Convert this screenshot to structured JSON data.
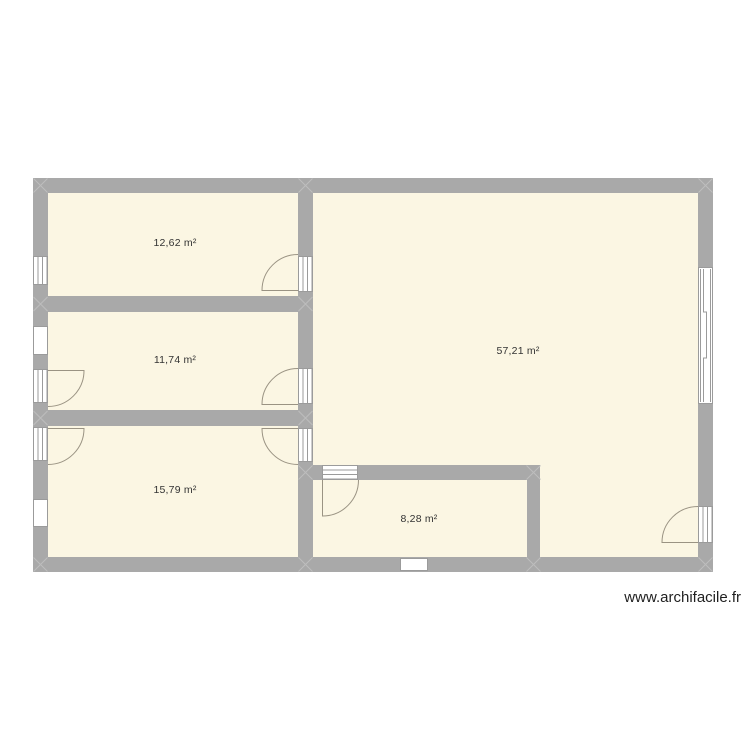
{
  "plan": {
    "rooms": [
      {
        "id": "room-1",
        "area_label": "12,62 m²"
      },
      {
        "id": "room-2",
        "area_label": "11,74 m²"
      },
      {
        "id": "room-3",
        "area_label": "15,79 m²"
      },
      {
        "id": "room-4",
        "area_label": "57,21 m²"
      },
      {
        "id": "room-5",
        "area_label": "8,28 m²"
      }
    ],
    "openings": {
      "windows": [
        "window-left-top",
        "window-left-middle",
        "window-left-bottom",
        "window-bottom",
        "sliding-window-right"
      ],
      "doors": [
        "door-left-room2",
        "door-left-room3",
        "door-room1-to-room4",
        "door-room2-to-room4",
        "door-room3-to-room4",
        "door-room5-top",
        "door-right-exterior"
      ]
    }
  },
  "watermark": {
    "text": "www.archifacile.fr"
  },
  "colors": {
    "wall": "#a9a9a9",
    "floor": "#fbf6e3",
    "arc": "#9a9383",
    "frame": "#9b9b9b",
    "label": "#333333",
    "junction": "#bdbdbd",
    "watermark": "#1f1f1f",
    "page-bg": "#ffffff"
  }
}
